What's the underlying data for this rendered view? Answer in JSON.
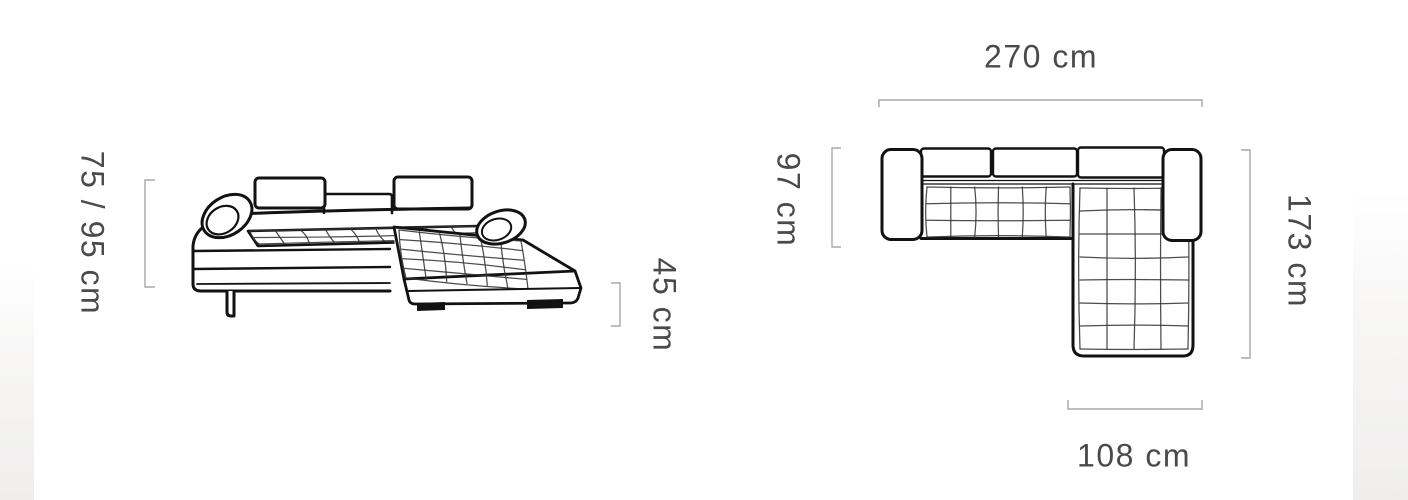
{
  "diagram": {
    "title": "corner-sofa-dimensions",
    "side_view": {
      "name": "sofa side view",
      "height_label": "75 / 95 cm",
      "seat_height_label": "45 cm"
    },
    "top_view": {
      "name": "sofa top view",
      "width_label": "270 cm",
      "depth_label": "97 cm",
      "length_label": "173 cm",
      "chaise_width_label": "108 cm"
    }
  },
  "colors": {
    "line": "#121212",
    "quilt": "#333333",
    "bracket": "#a9a9a9",
    "label": "#4a4a4a",
    "background": "#ffffff",
    "edge_shade": "#efeeed"
  }
}
